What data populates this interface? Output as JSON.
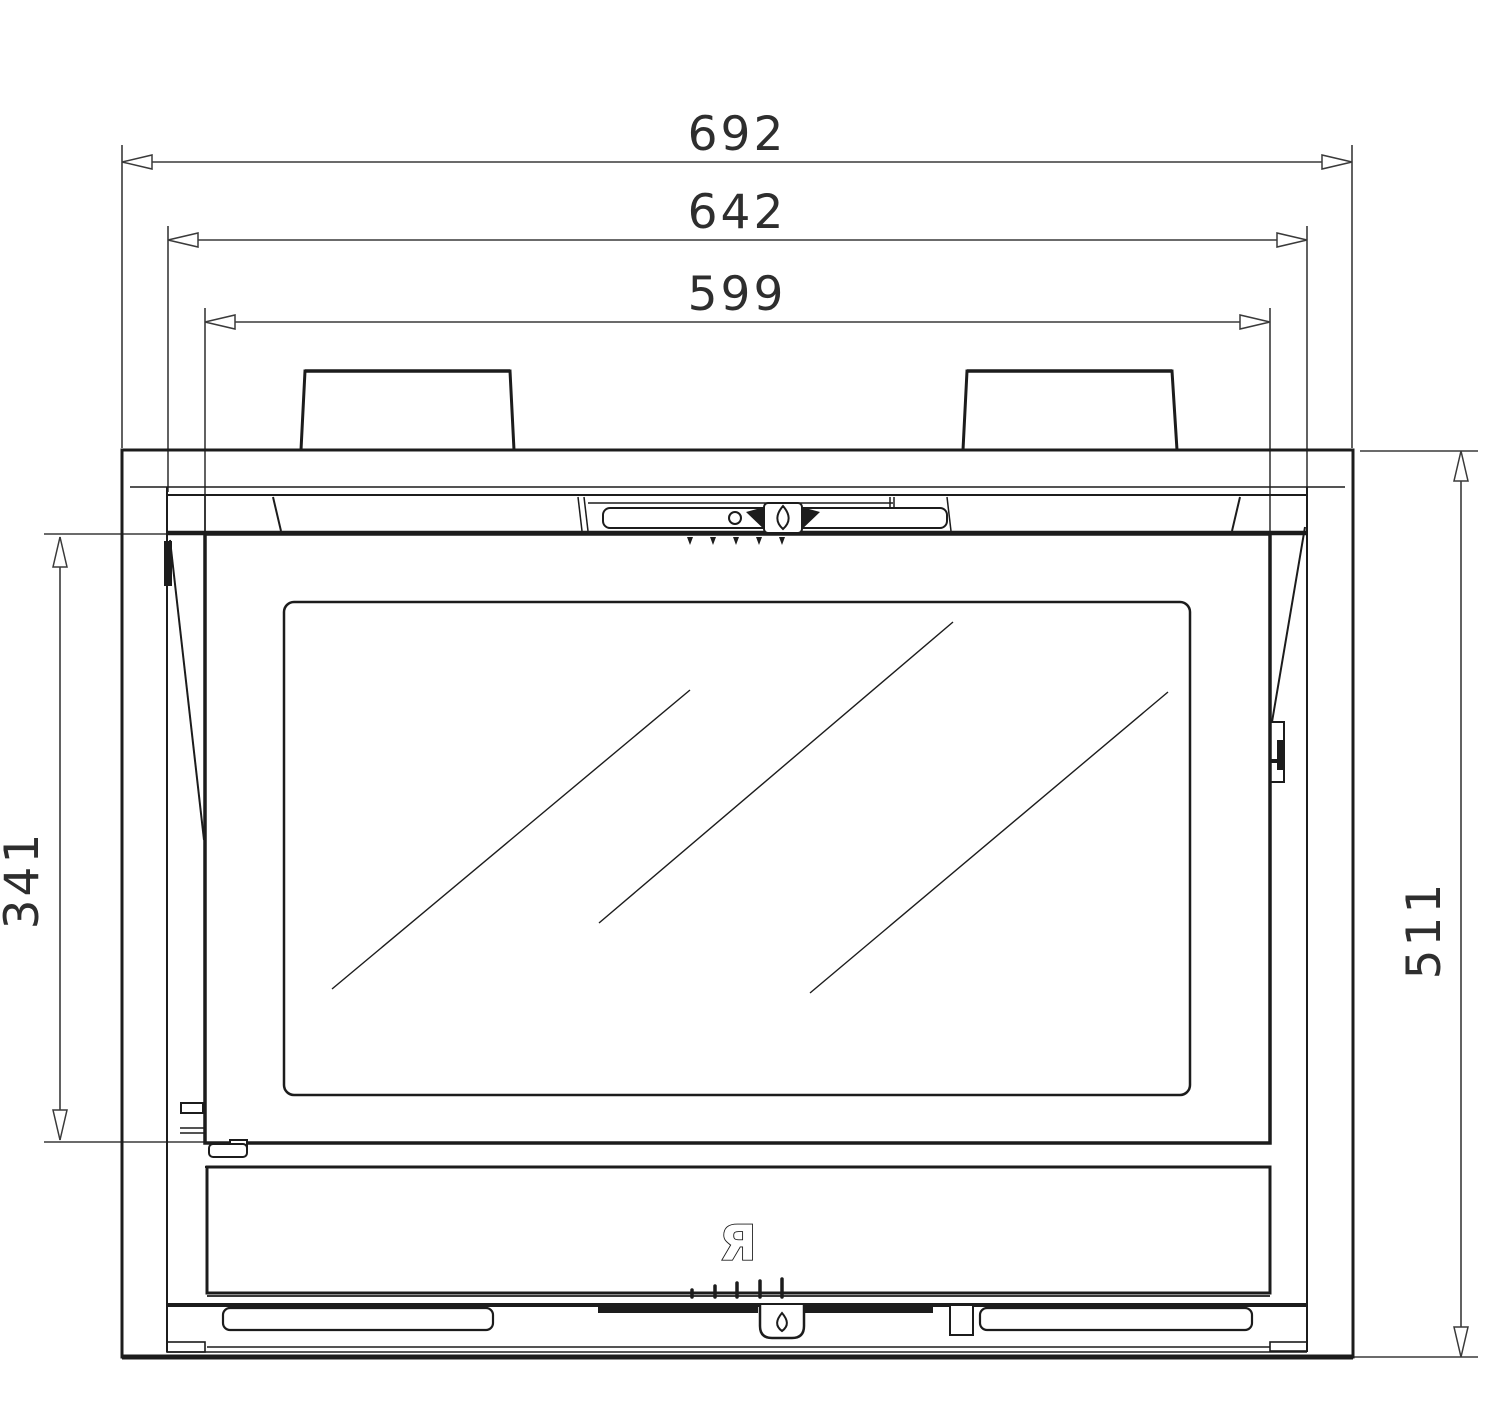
{
  "drawing": {
    "dimensions": {
      "overall_width": "692",
      "frame_width": "642",
      "door_width": "599",
      "door_height": "341",
      "overall_height": "511"
    },
    "logo_glyph": "Я",
    "colors": {
      "line": "#1c1c1c",
      "dimension": "#3a3a3a",
      "background": "#ffffff"
    }
  }
}
